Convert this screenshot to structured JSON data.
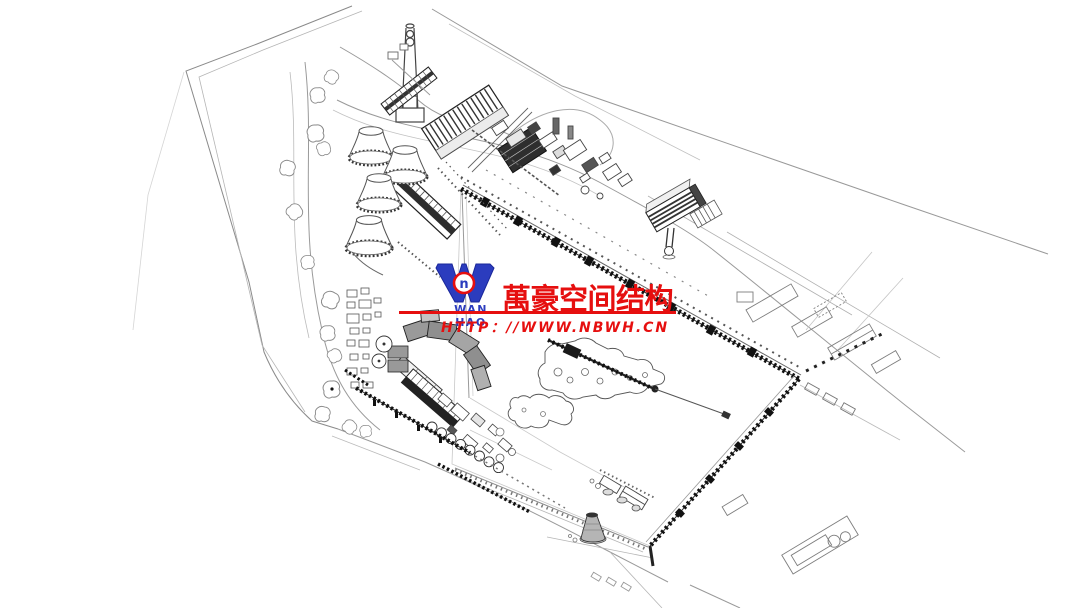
{
  "page": {
    "background": "#ffffff",
    "width": 1080,
    "height": 608
  },
  "watermark": {
    "logo_symbol": "W",
    "logo_ring_letter": "n",
    "logo_name": "WAN HAO",
    "company_name_cn": "萬豪空间结构",
    "website": "HTTP：//WWW.NBWH.CN",
    "red": "#e60f0f",
    "blue": "#2b3cbe"
  },
  "drawing": {
    "kind": "axonometric-power-plant-site-plan",
    "line_color": "#3c3c3c",
    "elements": [
      "site-boundary",
      "perimeter-roads",
      "trees",
      "cooling-towers",
      "chimney",
      "boiler-house",
      "machinery-cluster",
      "coal-conveyor-trestle",
      "office-building",
      "ribbed-warehouse",
      "south-complex",
      "tank-row",
      "water-intake-jetty",
      "pond",
      "pier",
      "cone-tower",
      "east-road-grid",
      "central-field"
    ]
  }
}
